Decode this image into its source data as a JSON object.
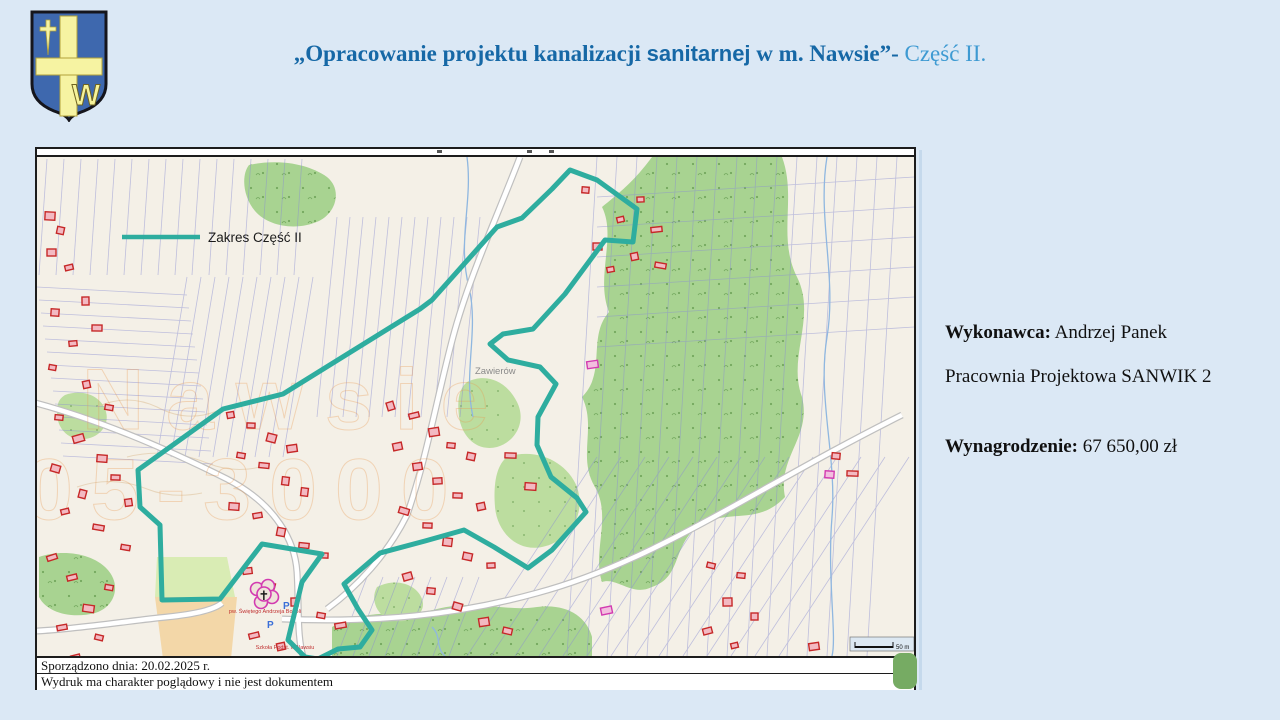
{
  "colors": {
    "background": "#dbe8f5",
    "title_dark_blue": "#1668a6",
    "title_light_blue": "#3e9ad2",
    "boundary_teal": "#2ead9f",
    "map_background": "#f4f0e7",
    "forest_green": "#a8d391",
    "building_red": "#c62828"
  },
  "header": {
    "crest_name": "coat-of-arms",
    "crest_letter": "W",
    "title_part1": "„Opracowanie projektu kanalizacji ",
    "title_part2": "sanitarnej",
    "title_part3": " w m. Nawsie”- ",
    "title_part4": "Część II."
  },
  "details": {
    "contractor_label": "Wykonawca:",
    "contractor_value": " Andrzej Panek",
    "contractor_line2": "Pracownia Projektowa SANWIK 2",
    "fee_label": "Wynagrodzenie:",
    "fee_value": " 67 650,00 zł"
  },
  "map": {
    "legend_label": "Zakres Część II",
    "scale_label": "50 m",
    "place_label": "Zawierów",
    "church_label": "pw. Świętego Andrzeja Boboli",
    "school_label": "Szkoła Podst. w Nawsiu",
    "watermark1": "Nawsie",
    "watermark2": "05-3000",
    "footer_line1": "Sporządzono dnia: 20.02.2025 r.",
    "footer_line2": "Wydruk ma charakter poglądowy i nie jest dokumentem",
    "boundary_points": [
      [
        533,
        13
      ],
      [
        560,
        23
      ],
      [
        600,
        52
      ],
      [
        596,
        85
      ],
      [
        568,
        83
      ],
      [
        528,
        137
      ],
      [
        496,
        172
      ],
      [
        466,
        177
      ],
      [
        453,
        187
      ],
      [
        471,
        203
      ],
      [
        503,
        210
      ],
      [
        519,
        227
      ],
      [
        501,
        260
      ],
      [
        500,
        288
      ],
      [
        514,
        320
      ],
      [
        540,
        341
      ],
      [
        549,
        355
      ],
      [
        515,
        393
      ],
      [
        491,
        411
      ],
      [
        457,
        390
      ],
      [
        427,
        373
      ],
      [
        388,
        384
      ],
      [
        343,
        396
      ],
      [
        307,
        427
      ],
      [
        321,
        452
      ],
      [
        335,
        473
      ],
      [
        323,
        490
      ],
      [
        301,
        492
      ],
      [
        281,
        502
      ],
      [
        268,
        500
      ],
      [
        251,
        483
      ],
      [
        265,
        425
      ],
      [
        285,
        397
      ],
      [
        225,
        387
      ],
      [
        183,
        442
      ],
      [
        125,
        443
      ],
      [
        123,
        368
      ],
      [
        103,
        350
      ],
      [
        101,
        313
      ],
      [
        186,
        252
      ],
      [
        246,
        237
      ],
      [
        383,
        152
      ],
      [
        395,
        143
      ],
      [
        460,
        70
      ],
      [
        485,
        61
      ],
      [
        515,
        32
      ],
      [
        533,
        13
      ]
    ]
  }
}
